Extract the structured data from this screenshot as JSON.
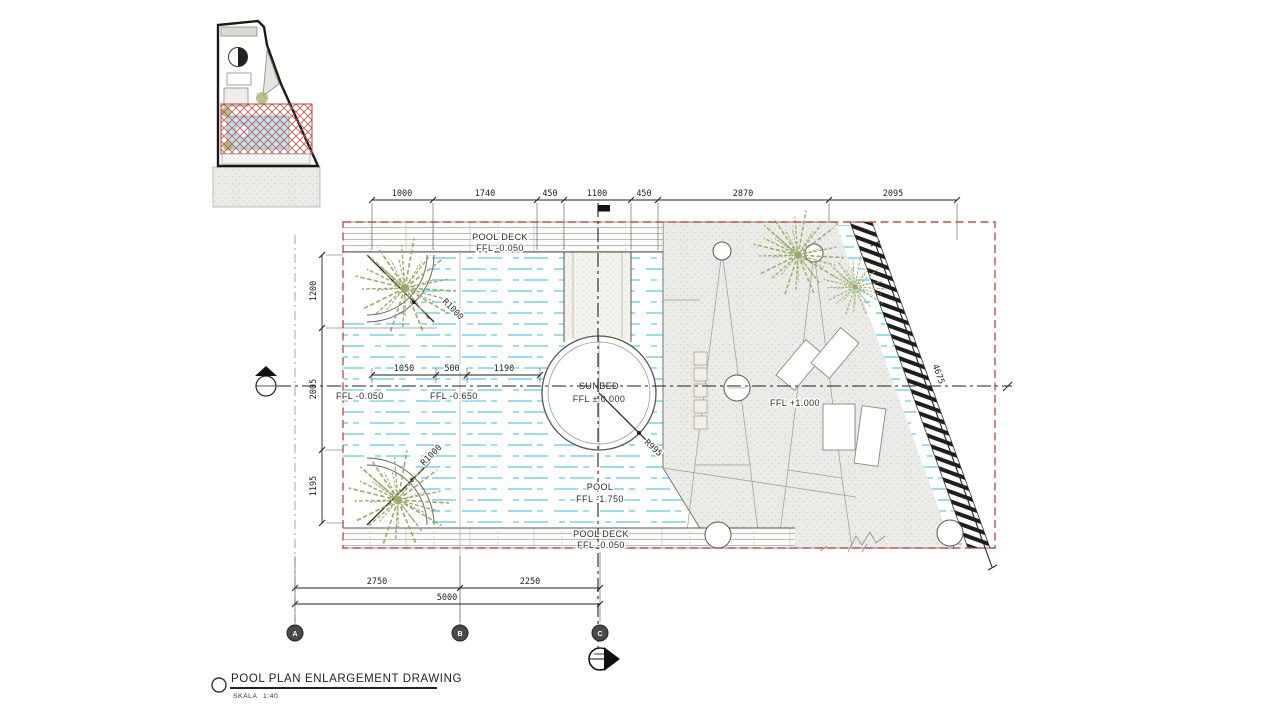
{
  "title_block": {
    "title": "POOL PLAN ENLARGEMENT DRAWING",
    "scale_label": "SKALA",
    "scale_value": "1:40"
  },
  "dimensions": {
    "top": [
      "1000",
      "1740",
      "450",
      "1100",
      "450",
      "2870",
      "2095"
    ],
    "left": [
      "1200",
      "2005",
      "1195"
    ],
    "inner": [
      "1050",
      "500",
      "1190"
    ],
    "bottom": [
      "2750",
      "2250"
    ],
    "overall": "5000",
    "diagonal": "4675"
  },
  "radii": {
    "top_left": "R1000",
    "sunbed": "R995",
    "bottom_left": "R1000"
  },
  "labels": {
    "pool_deck_top": {
      "name": "POOL DECK",
      "level": "FFL  -0.050"
    },
    "pool_deck_bottom": {
      "name": "POOL DECK",
      "level": "FFL  -0.050"
    },
    "sunbed": {
      "name": "SUNBED",
      "level": "FFL ± 0.000"
    },
    "pool": {
      "name": "POOL",
      "level": "FFL  -1.750"
    },
    "deck_left_level": "FFL  -0.050",
    "pool_mid_level": "FFL  -0.650",
    "terrace_level": "FFL  +1.000"
  },
  "grid_bubbles": [
    "A",
    "B",
    "C"
  ],
  "colors": {
    "boundary_red": "#c0524b",
    "water_cyan": "#8fd8e8",
    "foliage_green": "#9aab6c",
    "line_dark": "#333333",
    "deck_gray": "#a6a6a2"
  }
}
